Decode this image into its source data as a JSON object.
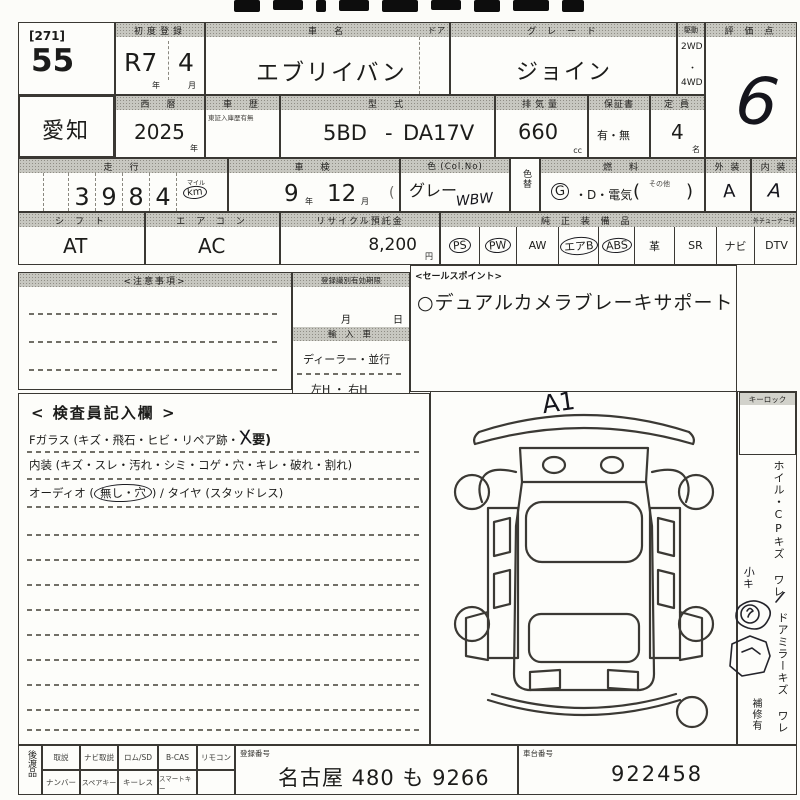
{
  "sheet": {
    "lot": {
      "series": "[271]",
      "number": "55"
    },
    "first_registration": {
      "label": "初度登録",
      "era_year": "R7",
      "month": "4",
      "year_unit": "年",
      "month_unit": "月"
    },
    "car_name": {
      "label": "車　名",
      "door_label": "ドア",
      "value": "エブリイバン"
    },
    "grade": {
      "label": "グ レ ー ド",
      "value": "ジョイン"
    },
    "drive": {
      "label": "駆動",
      "top": "2WD",
      "mid": "・",
      "bottom": "4WD"
    },
    "score": {
      "label": "評 価 点",
      "value": "6"
    },
    "prefecture": "愛知",
    "west_year": {
      "label": "西　暦",
      "value": "2025",
      "unit": "年"
    },
    "history": {
      "label": "車　歴",
      "note": "東証入庫歴有無"
    },
    "model_code": {
      "label": "型　式",
      "prefix": "5BD",
      "separator": "-",
      "value": "DA17V"
    },
    "displacement": {
      "label": "排気量",
      "value": "660",
      "unit": "cc"
    },
    "warranty": {
      "label": "保証書",
      "value": "有・無"
    },
    "capacity": {
      "label": "定 員",
      "value": "4",
      "unit": "名"
    },
    "mileage": {
      "label": "走　行",
      "digits": [
        "3",
        "9",
        "8",
        "4"
      ],
      "mile_label": "マイル",
      "km_label": "km"
    },
    "inspection_expiry": {
      "label": "車　検",
      "year": "9",
      "year_unit": "年",
      "month": "12",
      "month_unit": "月",
      "paren": "("
    },
    "color": {
      "label": "色 (Col.No)",
      "value": "グレー",
      "code": "WBW",
      "change_label": "色替"
    },
    "fuel": {
      "label": "燃　料",
      "gas": "G",
      "rest": "・D・電気",
      "paren_open": "(",
      "other": "その他",
      "paren_close": ")"
    },
    "exterior": {
      "label": "外 装",
      "value": "A"
    },
    "interior": {
      "label": "内 装",
      "value": "A"
    },
    "shift": {
      "label": "シ フ ト",
      "value": "AT"
    },
    "aircon": {
      "label": "エ ア コ ン",
      "value": "AC"
    },
    "recycle_deposit": {
      "label": "リサイクル預託金",
      "value": "8,200",
      "unit": "円"
    },
    "equipment": {
      "label": "純 正 装 備 品",
      "tuner_note": "外チューナー可",
      "items": [
        {
          "text": "PS",
          "circled": true
        },
        {
          "text": "PW",
          "circled": true
        },
        {
          "text": "AW",
          "circled": false
        },
        {
          "text": "エアB",
          "circled": true
        },
        {
          "text": "ABS",
          "circled": true
        },
        {
          "text": "革",
          "circled": false
        },
        {
          "text": "SR",
          "circled": false
        },
        {
          "text": "ナビ",
          "circled": false
        },
        {
          "text": "DTV",
          "circled": false
        }
      ]
    },
    "notes_label": "<注意事項>",
    "registration_id": {
      "label": "登録識別有効期限",
      "month_unit": "月",
      "day_unit": "日"
    },
    "import_car": {
      "label": "輸 入 車",
      "dealer_parallel": "ディーラー・並行",
      "handle": "左H ・ 右H"
    },
    "sales_point": {
      "label": "<セールスポイント>",
      "value": "○デュアルカメラブレーキサポート"
    },
    "inspector": {
      "title": "< 検査員記入欄 >",
      "glass_line": "Fガラス (キズ・飛石・ヒビ・リペア跡・",
      "glass_mark": "X",
      "glass_tail": "要)",
      "interior_line": "内装 (キズ・スレ・汚れ・シミ・コゲ・穴・キレ・破れ・割れ)",
      "audio_pre": "オーディオ (",
      "audio_circled": "無し・穴",
      "audio_post": ") / タイヤ (スタッドレス)"
    },
    "diagram": {
      "annotation": "A1",
      "keylock_label": "キーロック"
    },
    "side_notes": {
      "wheel": "ホイル・CPキズ ワレ",
      "hand_note": "小キ",
      "mirror": "ドアミラーキズ ワレ",
      "repair": "補修有"
    },
    "handover": {
      "label": "後渡品",
      "row1": [
        "取説",
        "ナビ取説",
        "ロム/SD",
        "B-CAS",
        "リモコン"
      ],
      "row2": [
        "ナンバー",
        "スペアキー",
        "キーレス",
        "スマートキー"
      ]
    },
    "registration_number": {
      "label": "登録番号",
      "value": "名古屋 480 も 9266"
    },
    "chassis_number": {
      "label": "車台番号",
      "value": "922458"
    }
  }
}
